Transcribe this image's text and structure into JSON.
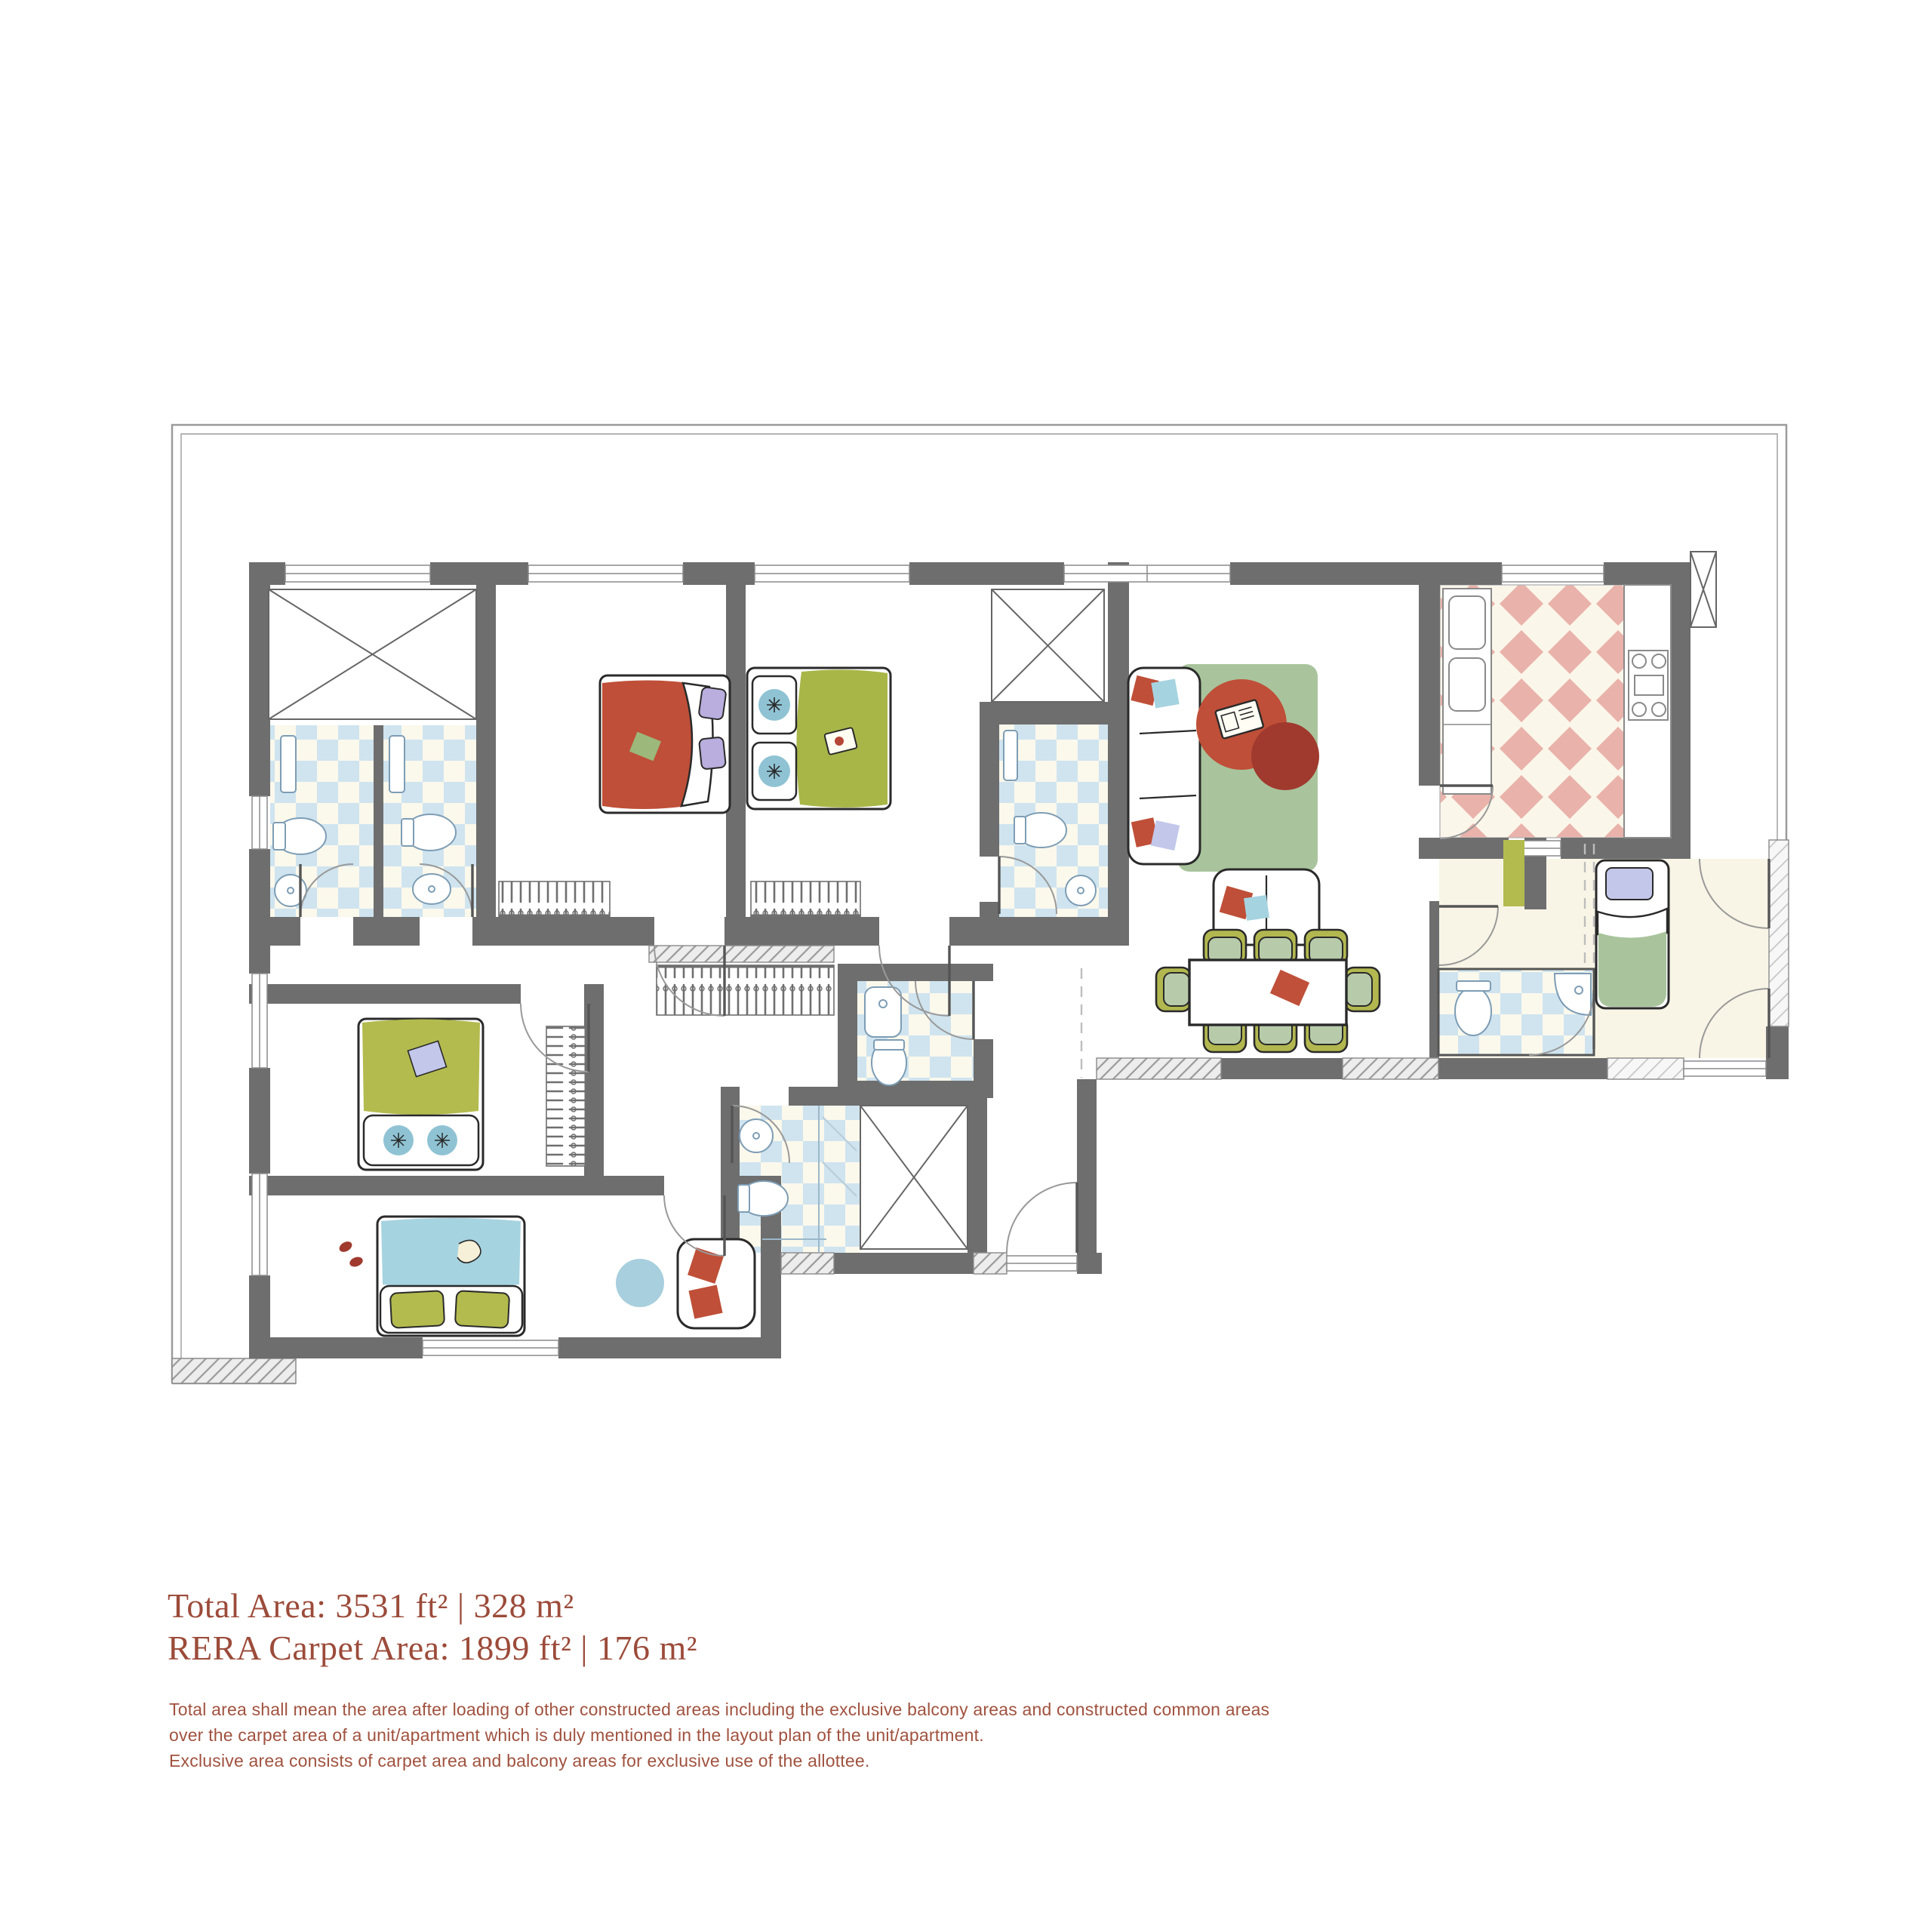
{
  "summary": {
    "total_area": "Total Area: 3531 ft² | 328 m²",
    "rera_carpet_area": "RERA Carpet Area: 1899 ft² | 176 m²",
    "text_color": "#9c4b3a"
  },
  "disclaimer": {
    "lines": [
      "Total area shall mean the area after loading of other constructed areas including the exclusive balcony areas and constructed common areas",
      "over the carpet area of a unit/apartment which is duly mentioned in the layout plan of the unit/apartment.",
      "Exclusive area consists of carpet area and balcony areas for exclusive use of the allottee."
    ]
  },
  "plan": {
    "type": "apartment-floor-plan",
    "colors": {
      "wall_gray": "#6e6e6e",
      "hatch_gray": "#9a9a9a",
      "tile_blue": "#cfe4ef",
      "tile_cream": "#fbf8ec",
      "kitchen_tile_pink": "#e9b2aa",
      "rug_green": "#a9c49c",
      "accent_red": "#bf4f38",
      "accent_red_dark": "#a03a2e",
      "olive": "#b2b84f",
      "bed_blue": "#a6d3e0",
      "pillow_blue": "#8fc3d4",
      "pillow_purple": "#b9aede",
      "utility_floor_ivory": "#f8f5e6"
    },
    "rooms": [
      "terrace",
      "master-bedroom",
      "bedroom-2",
      "bedroom-3",
      "bedroom-4",
      "living-room",
      "dining-area",
      "kitchen",
      "utility-room",
      "entry-foyer",
      "bathroom-1",
      "bathroom-2",
      "bathroom-3",
      "powder-room",
      "shower-bathroom",
      "utility-bathroom",
      "shaft-1",
      "shaft-2",
      "shaft-3",
      "kitchen-duct"
    ],
    "furniture": [
      "double-bed-red",
      "double-bed-green",
      "double-bed-olive",
      "double-bed-blue",
      "single-bed-utility",
      "sofa-3-seat",
      "loveseat",
      "armchair",
      "coffee-table",
      "dining-table-8-chairs",
      "wardrobe-combs",
      "toilets",
      "wash-basins",
      "kitchen-sink-counter",
      "kitchen-hob"
    ]
  }
}
